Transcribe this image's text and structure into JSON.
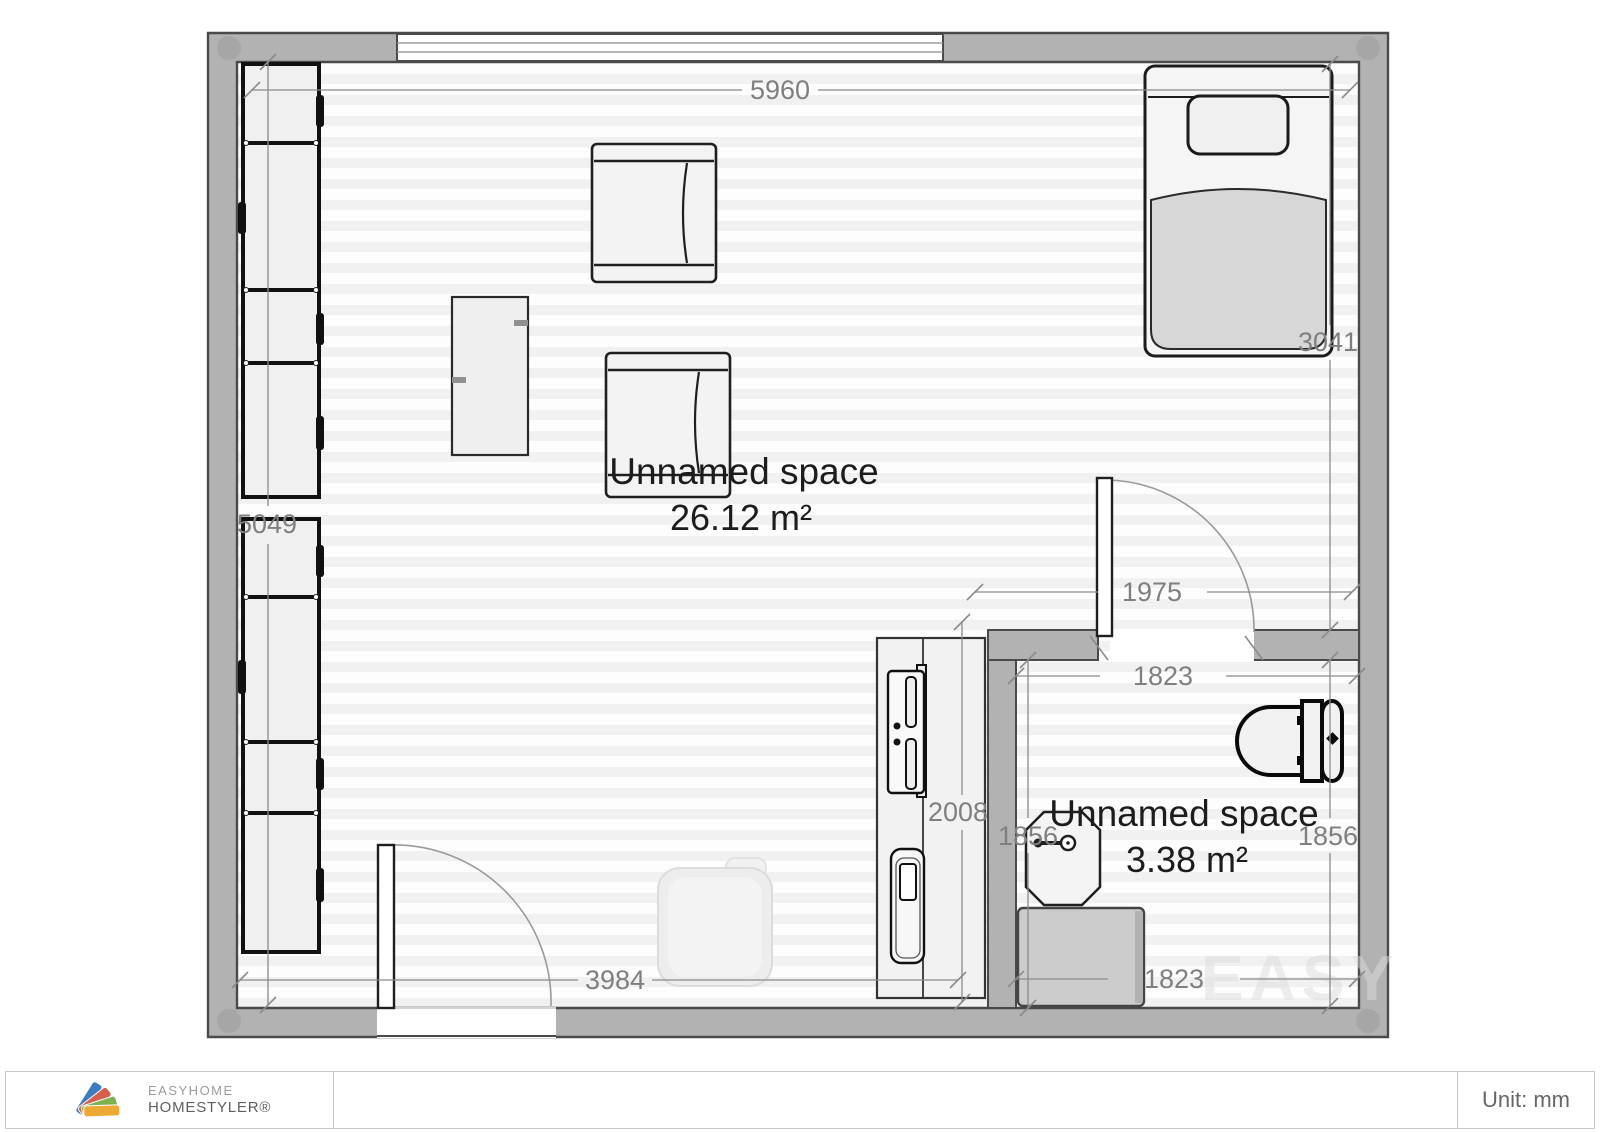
{
  "app": {
    "logo_line1": "EASYHOME",
    "logo_line2": "HOMESTYLER®"
  },
  "footer": {
    "unit_label": "Unit: mm"
  },
  "watermark": "EASY",
  "rooms": {
    "living": {
      "name": "Unnamed space",
      "area": "26.12 m²"
    },
    "bathroom": {
      "name": "Unnamed space",
      "area": "3.38 m²"
    }
  },
  "dimensions_mm": {
    "top_wall_width": "5960",
    "left_wall_height": "5049",
    "right_wall_upper": "3041",
    "bathroom_entry_span": "1975",
    "bathroom_width_top": "1823",
    "bathroom_width_bottom": "1823",
    "bathroom_height_left": "1856",
    "bathroom_height_right": "1856",
    "kitchen_counter_length": "2008",
    "bottom_wall_left_span": "3984"
  },
  "colors": {
    "wall_fill": "#b2b2b2",
    "wall_outline": "#4a4a4a",
    "dimension_gray": "#8a8a8a",
    "label_black": "#1c1c1c",
    "logo_blue": "#3e7dbd",
    "logo_red": "#d4604d",
    "logo_green": "#7eb24e",
    "logo_yellow": "#eda933"
  }
}
